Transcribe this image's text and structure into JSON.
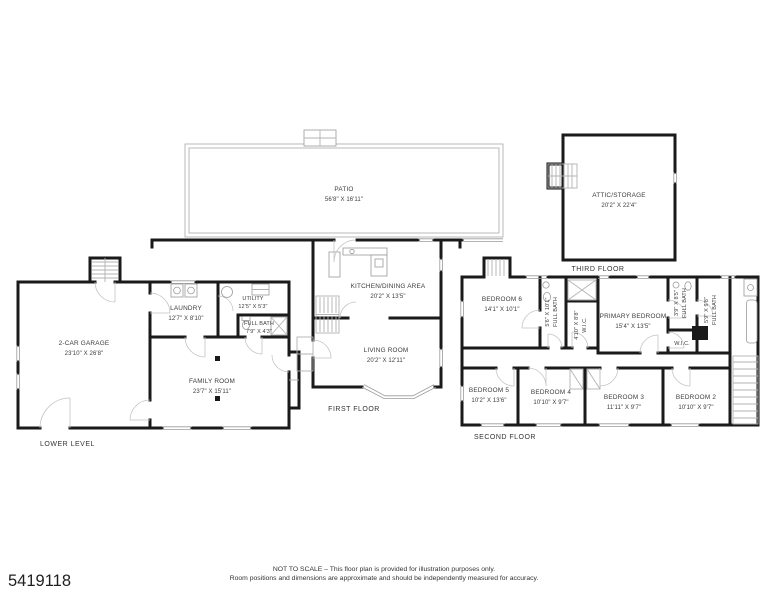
{
  "patio": {
    "name": "PATIO",
    "dims": "56'8\" X 16'11\""
  },
  "floors": {
    "lower_level": {
      "label": "LOWER LEVEL",
      "rooms": {
        "garage": {
          "name": "2-CAR GARAGE",
          "dims": "23'10\" X 26'8\""
        },
        "laundry": {
          "name": "LAUNDRY",
          "dims": "12'7\" X 8'10\""
        },
        "utility": {
          "name": "UTILITY",
          "dims": "12'5\" X 5'3\""
        },
        "full_bath": {
          "name": "FULL BATH",
          "dims": "7'9\" X 4'3\""
        },
        "family_room": {
          "name": "FAMILY ROOM",
          "dims": "23'7\" X 15'11\""
        }
      }
    },
    "first_floor": {
      "label": "FIRST FLOOR",
      "rooms": {
        "kitchen_dining": {
          "name": "KITCHEN/DINING AREA",
          "dims": "20'2\" X 13'5\""
        },
        "living_room": {
          "name": "LIVING ROOM",
          "dims": "20'2\" X 12'11\""
        }
      }
    },
    "second_floor": {
      "label": "SECOND FLOOR",
      "rooms": {
        "bedroom_6": {
          "name": "BEDROOM 6",
          "dims": "14'1\" X 10'1\""
        },
        "full_bath_1": {
          "name": "FULL BATH",
          "dims": "5'6\" X 10'1\""
        },
        "wic_1": {
          "name": "W.I.C.",
          "dims": "4'10\" X 8'8\""
        },
        "primary_bedroom": {
          "name": "PRIMARY BEDROOM",
          "dims": "15'4\" X 13'5\""
        },
        "full_bath_2": {
          "name": "FULL BATH",
          "dims": "3'9\" X 8'5\""
        },
        "full_bath_3": {
          "name": "FULL BATH",
          "dims": "5'9\" X 9'8\""
        },
        "wic_2": {
          "name": "W.I.C."
        },
        "bedroom_5": {
          "name": "BEDROOM 5",
          "dims": "10'2\" X 13'6\""
        },
        "bedroom_4": {
          "name": "BEDROOM 4",
          "dims": "10'10\" X 9'7\""
        },
        "bedroom_3": {
          "name": "BEDROOM 3",
          "dims": "11'11\" X 9'7\""
        },
        "bedroom_2": {
          "name": "BEDROOM 2",
          "dims": "10'10\" X 9'7\""
        }
      }
    },
    "third_floor": {
      "label": "THIRD FLOOR",
      "rooms": {
        "attic": {
          "name": "ATTIC/STORAGE",
          "dims": "20'2\" X 22'4\""
        }
      }
    }
  },
  "footer": {
    "listing_id": "5419118",
    "disclaimer_line1": "NOT TO SCALE – This floor plan is provided for illustration purposes only.",
    "disclaimer_line2": "Room positions and dimensions are approximate and should be independently measured for accuracy."
  }
}
